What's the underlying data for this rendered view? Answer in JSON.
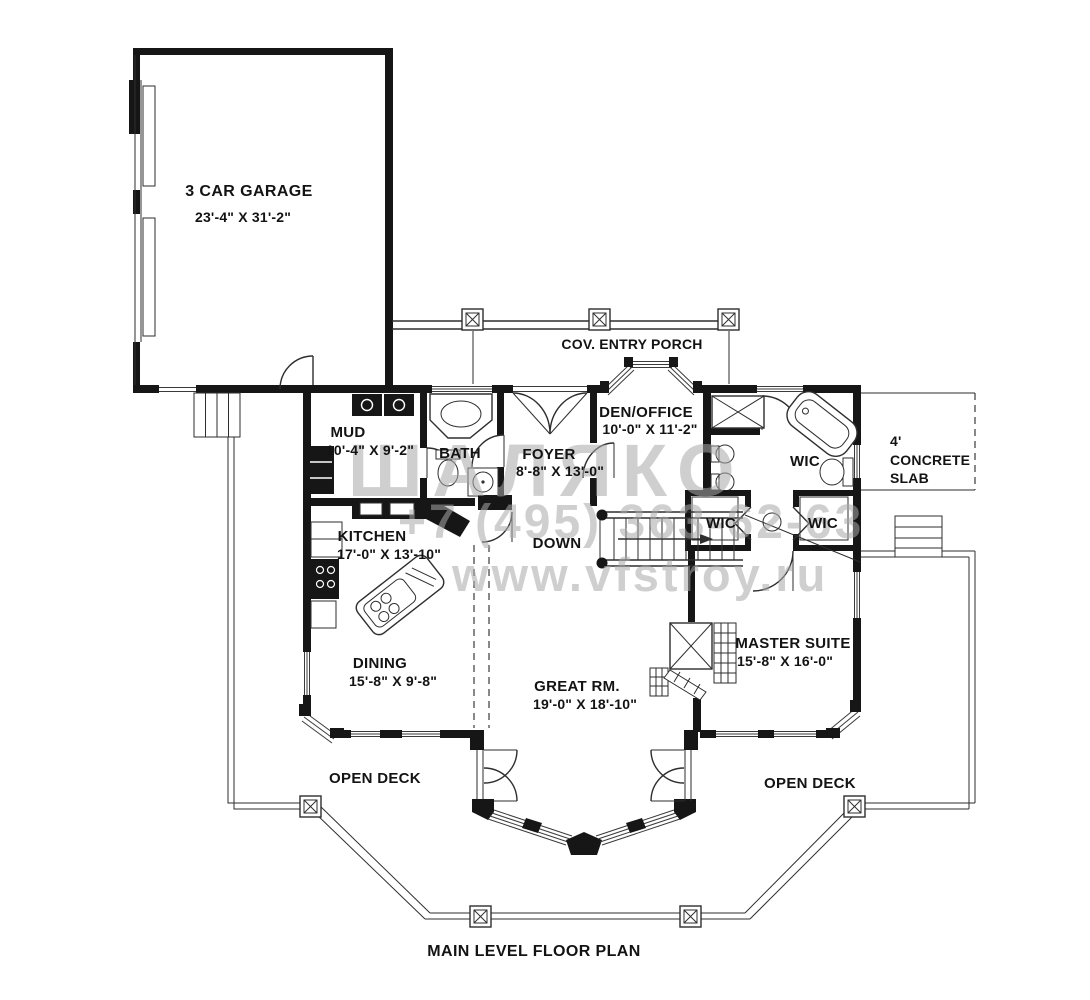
{
  "title": "MAIN LEVEL FLOOR PLAN",
  "rooms": {
    "garage": {
      "name": "3 CAR GARAGE",
      "dims": "23'-4\" X 31'-2\""
    },
    "porch": {
      "name": "COV. ENTRY PORCH"
    },
    "mud": {
      "name": "MUD",
      "dims": "10'-4\" X 9'-2\""
    },
    "bath": {
      "name": "BATH"
    },
    "foyer": {
      "name": "FOYER",
      "dims": "8'-8\" X 13'-0\""
    },
    "den": {
      "name": "DEN/OFFICE",
      "dims": "10'-0\" X 11'-2\""
    },
    "slab": {
      "line1": "4'",
      "line2": "CONCRETE",
      "line3": "SLAB"
    },
    "wic_upper": {
      "name": "WIC"
    },
    "wic_left": {
      "name": "WIC"
    },
    "wic_right": {
      "name": "WIC"
    },
    "kitchen": {
      "name": "KITCHEN",
      "dims": "17'-0\" X 13'-10\""
    },
    "stairs": {
      "name": "DOWN"
    },
    "dining": {
      "name": "DINING",
      "dims": "15'-8\" X 9'-8\""
    },
    "great_room": {
      "name": "GREAT RM.",
      "dims": "19'-0\" X 18'-10\""
    },
    "master": {
      "name": "MASTER SUITE",
      "dims": "15'-8\" X 16'-0\""
    },
    "deck_left": {
      "name": "OPEN DECK"
    },
    "deck_right": {
      "name": "OPEN DECK"
    }
  },
  "watermark": {
    "brand": "ШАЛЯКО",
    "phone": "+7 (495) 363-62-63",
    "site": "www.vfstroy.ru"
  },
  "colors": {
    "wall": "#161616",
    "line": "#2e2e2e",
    "watermark": "#a8a8a8",
    "background": "#ffffff",
    "text": "#131313"
  }
}
